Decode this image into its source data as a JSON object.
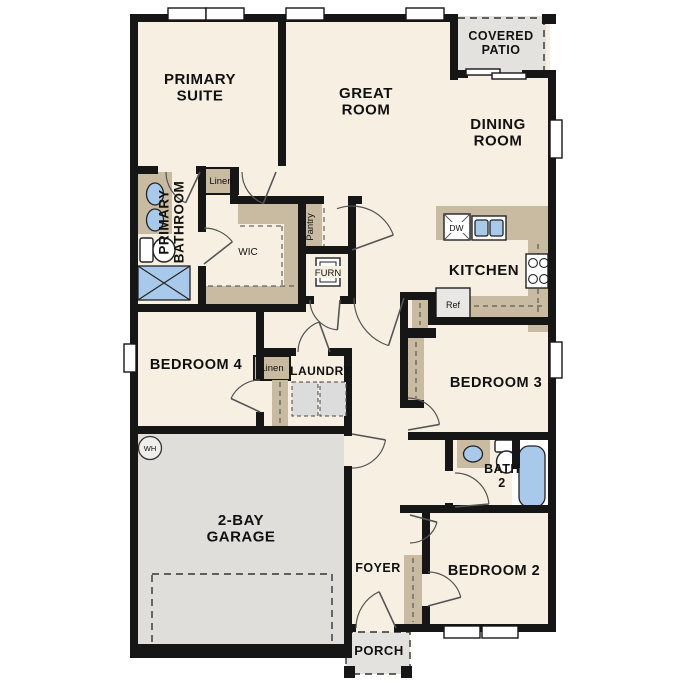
{
  "colors": {
    "floor": "#f7efe2",
    "wall": "#161616",
    "cabinet_tan": "#c8bba1",
    "garage_gray": "#dfdedb",
    "patio_gray": "#e3e2df",
    "fixture_blue": "#a9c9ea",
    "label_text": "#111111",
    "background": "#ffffff"
  },
  "labels": {
    "primary_suite": "PRIMARY\nSUITE",
    "great_room": "GREAT\nROOM",
    "dining_room": "DINING\nROOM",
    "covered_patio": "COVERED\nPATIO",
    "kitchen": "KITCHEN",
    "primary_bathroom": "PRIMARY\nBATHROOM",
    "wic": "WIC",
    "linen_top": "Linen",
    "pantry": "Pantry",
    "furnace": "FURN",
    "bedroom_4": "BEDROOM 4",
    "laundry": "LAUNDRY",
    "linen_hall": "Linen",
    "opt_dryer": "Opt.\nD",
    "opt_washer": "Opt.\nW",
    "bedroom_3": "BEDROOM 3",
    "bath_2": "BATH\n2",
    "bedroom_2": "BEDROOM 2",
    "foyer": "FOYER",
    "porch": "PORCH",
    "garage": "2-BAY\nGARAGE",
    "water_heater": "WH",
    "dishwasher": "DW",
    "refrigerator": "Ref"
  }
}
